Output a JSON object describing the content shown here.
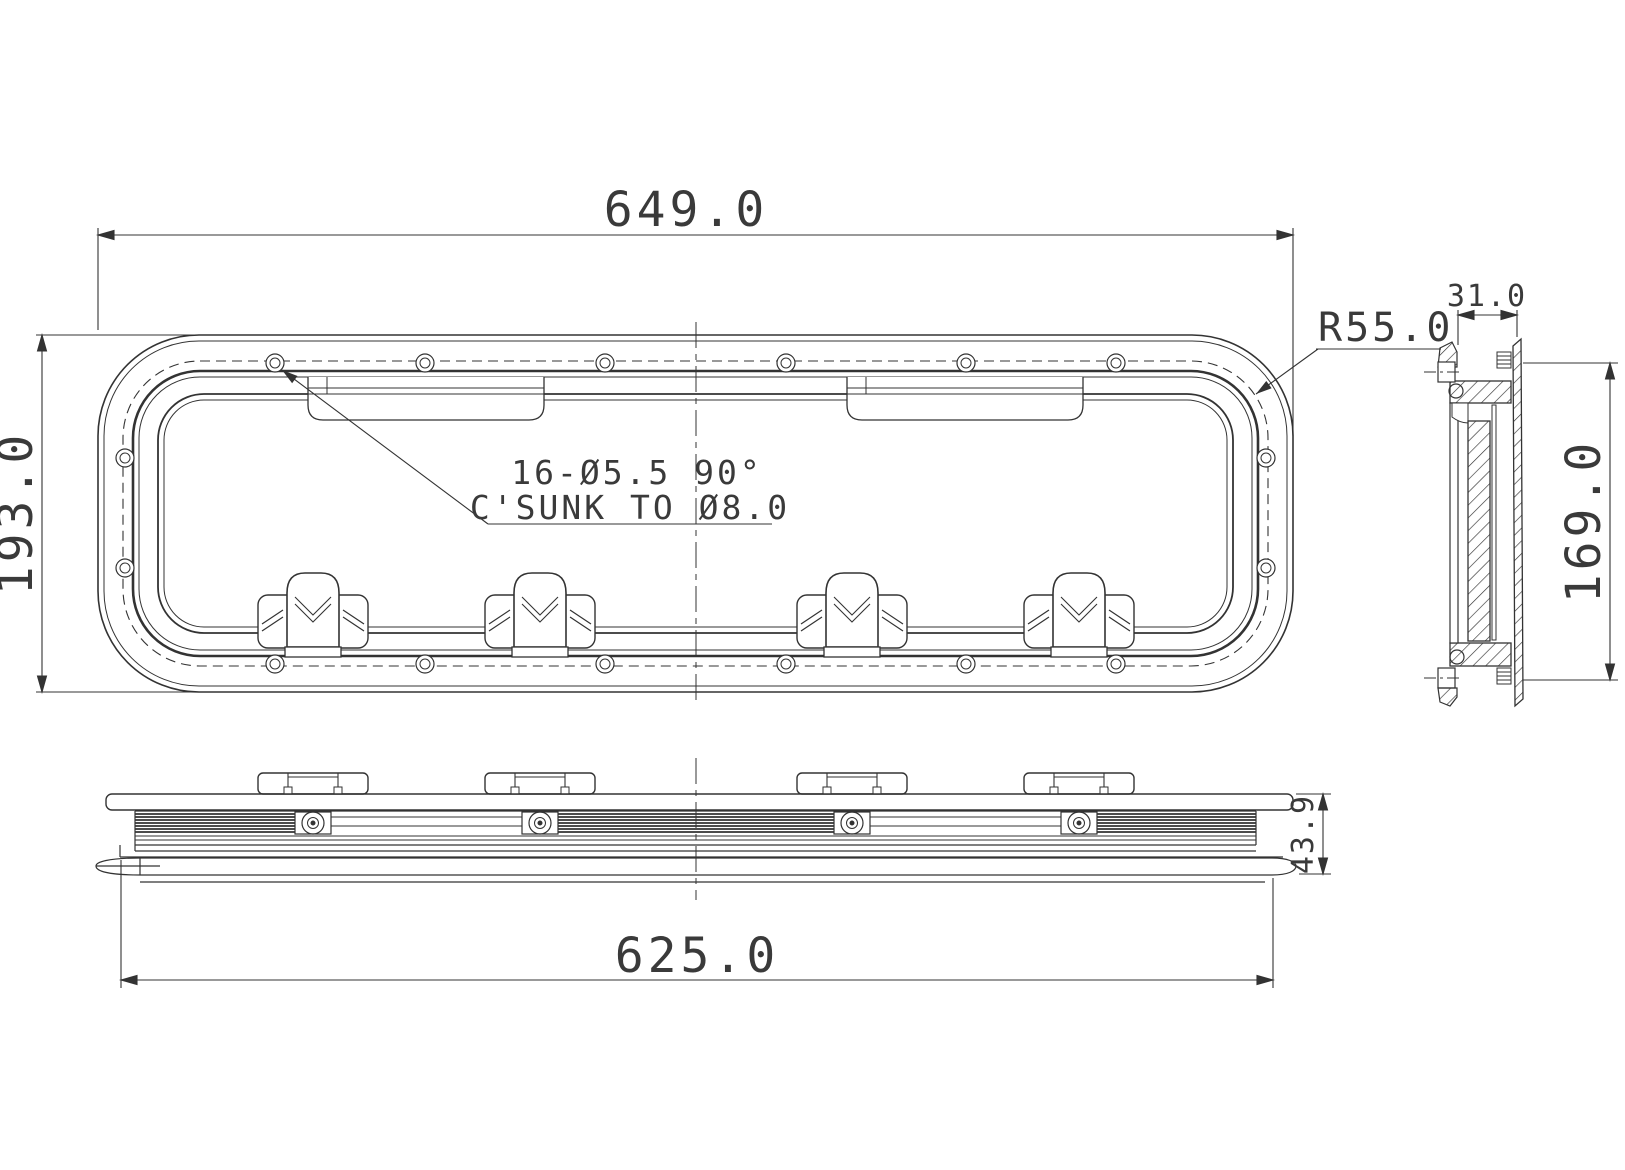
{
  "drawing": {
    "type": "technical-orthographic-drawing",
    "subject": "rectangular porthole / hatch window with rounded corners, three views",
    "colors": {
      "line": "#333333",
      "dim_text": "#3a3a3a",
      "background": "#ffffff"
    },
    "front_view": {
      "width_dim": "649.0",
      "height_dim": "193.0",
      "corner_radius_dim": "R55.0",
      "holes_note_line1": "16-Ø5.5 90°",
      "holes_note_line2": "C'SUNK TO Ø8.0",
      "screw_count": 16,
      "latch_count": 4
    },
    "side_view": {
      "thickness_dim": "31.0",
      "height_dim": "169.0"
    },
    "bottom_view": {
      "width_dim": "625.0",
      "height_dim": "43.9",
      "handle_count": 4
    }
  }
}
